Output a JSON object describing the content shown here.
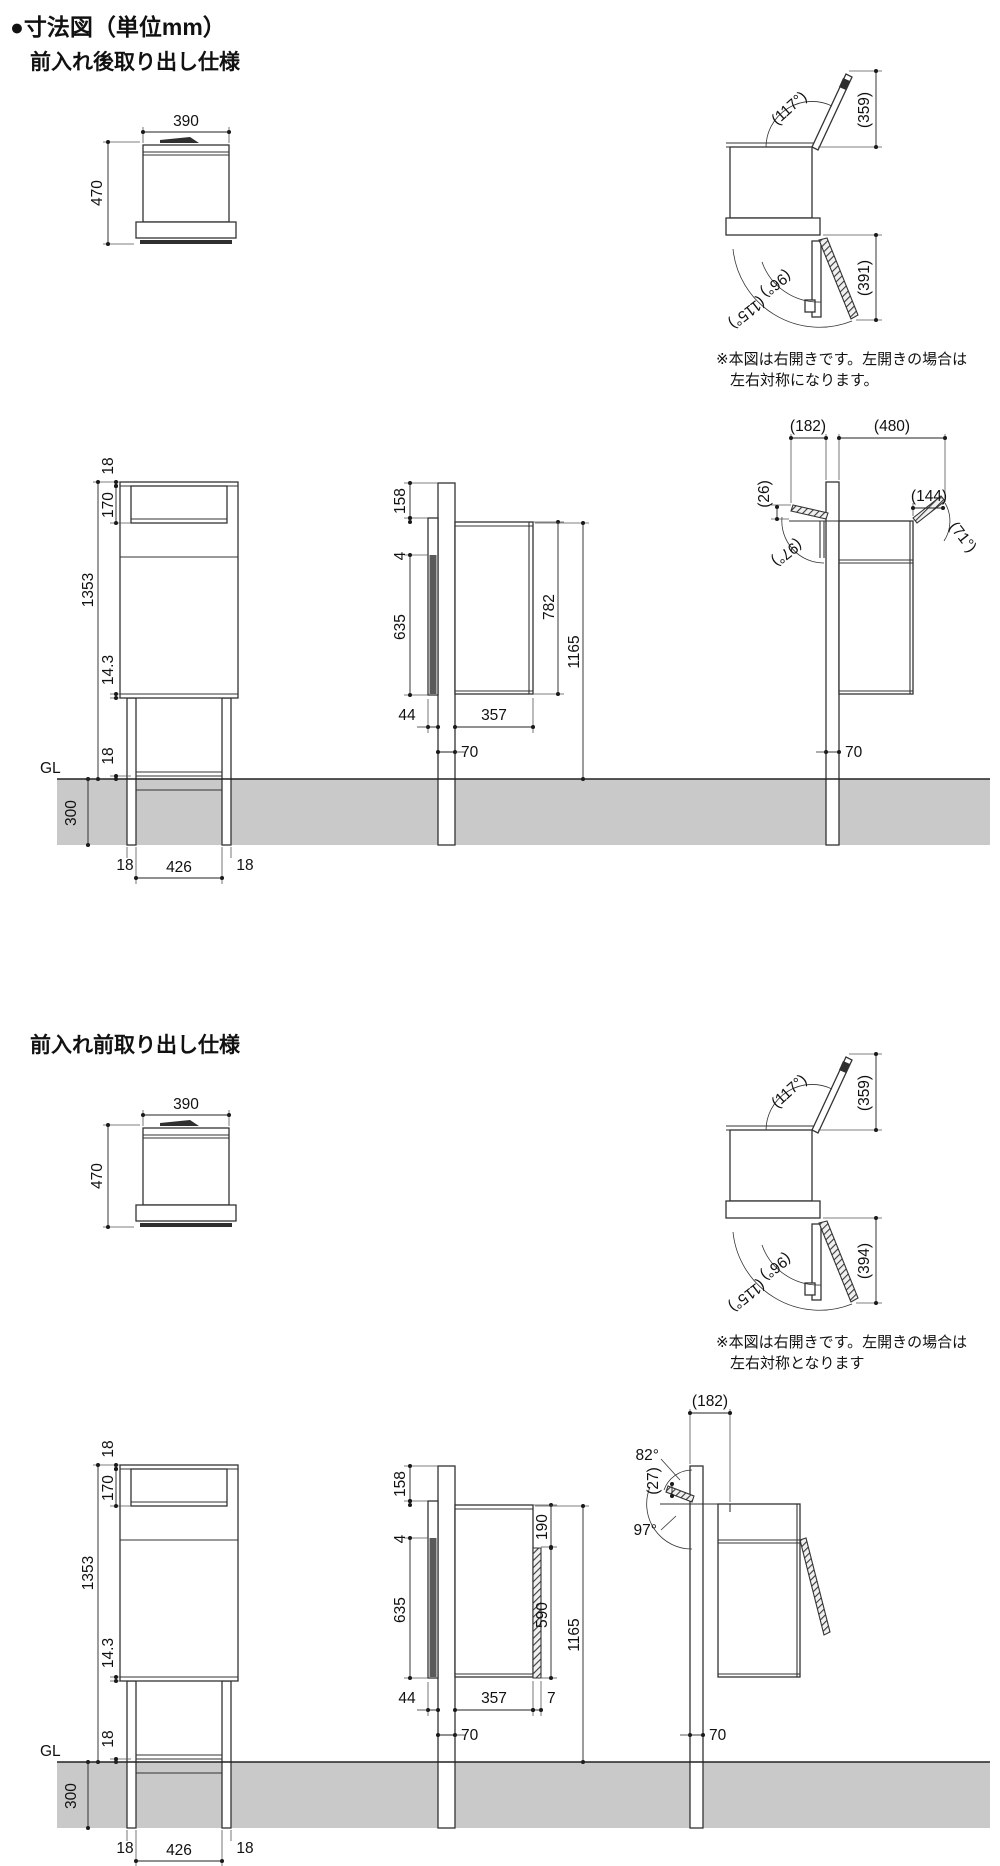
{
  "page": {
    "title": "●寸法図（単位mm）"
  },
  "s1": {
    "heading": "前入れ後取り出し仕様",
    "note": {
      "line1": "※本図は右開きです。左開きの場合は",
      "line2": "左右対称になります。"
    },
    "front_view": {
      "width": "390",
      "height": "470"
    },
    "open_view": {
      "lid_angle": "(117°)",
      "lid_height": "(359)",
      "door_angle_inner": "(96°)",
      "door_angle_outer": "(115°)",
      "door_reach": "(391)"
    },
    "front_elevation": {
      "top_frame": "18",
      "opening": "170",
      "total": "1353",
      "rail": "14.3",
      "above_gl": "18",
      "gl": "GL",
      "embed": "300",
      "post_left": "18",
      "span": "426",
      "post_right": "18"
    },
    "side_elevation": {
      "top_offset": "158",
      "lip": "4",
      "door": "635",
      "box": "782",
      "height": "1165",
      "offset": "44",
      "depth": "357",
      "post": "70"
    },
    "open_elevation": {
      "rear_reach": "(182)",
      "front_reach": "(480)",
      "rise": "(26)",
      "rear_angle": "(97°)",
      "lid_reach": "(144)",
      "lid_angle": "(71°)",
      "post": "70"
    }
  },
  "s2": {
    "heading": "前入れ前取り出し仕様",
    "note": {
      "line1": "※本図は右開きです。左開きの場合は",
      "line2": "左右対称となります"
    },
    "front_view": {
      "width": "390",
      "height": "470"
    },
    "open_view": {
      "lid_angle": "(117°)",
      "lid_height": "(359)",
      "door_angle_inner": "(96°)",
      "door_angle_outer": "(115°)",
      "door_reach": "(394)"
    },
    "front_elevation": {
      "top_frame": "18",
      "opening": "170",
      "total": "1353",
      "rail": "14.3",
      "above_gl": "18",
      "gl": "GL",
      "embed": "300",
      "post_left": "18",
      "span": "426",
      "post_right": "18"
    },
    "side_elevation": {
      "top_offset": "158",
      "lip": "4",
      "rear": "635",
      "opening": "190",
      "door": "590",
      "height": "1165",
      "offset": "44",
      "depth": "357",
      "door_thickness": "7",
      "post": "70"
    },
    "open_elevation": {
      "reach": "(182)",
      "upper_angle": "82°",
      "gap": "(27)",
      "lower_angle": "97°",
      "post": "70"
    }
  }
}
